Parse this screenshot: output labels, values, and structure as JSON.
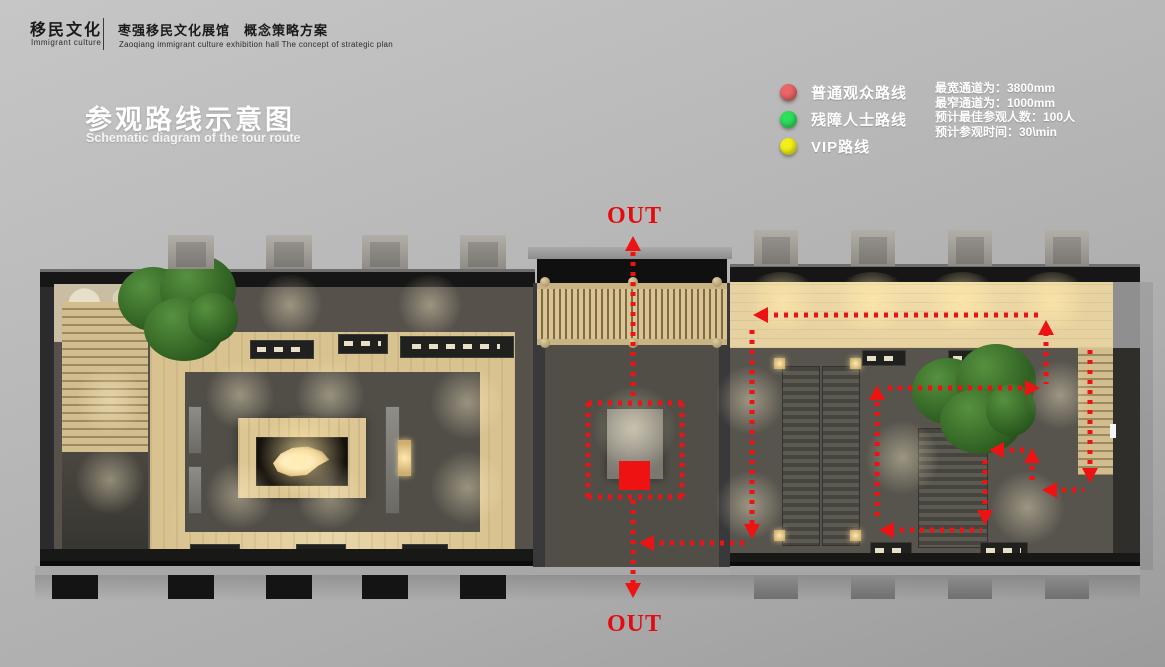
{
  "header": {
    "brand_cn": "移民文化",
    "brand_en": "Immigrant culture",
    "project_cn": "枣强移民文化展馆　概念策略方案",
    "project_en": "Zaoqiang immigrant culture exhibition hall  The concept of strategic plan"
  },
  "title": {
    "cn": "参观路线示意图",
    "en": "Schematic diagram of the tour route"
  },
  "legend": {
    "items": [
      {
        "name": "ordinary-visitor-route",
        "label": "普通观众路线",
        "color": "#e96666"
      },
      {
        "name": "disabled-visitor-route",
        "label": "残障人士路线",
        "color": "#2ce05a"
      },
      {
        "name": "vip-route",
        "label": "VIP路线",
        "color": "#f2ef18"
      }
    ]
  },
  "stats": {
    "lines": [
      "最宽通道为：3800mm",
      "最窄通道为：1000mm",
      "预计最佳参观人数：100人",
      "预计参观时间：30\\min"
    ]
  },
  "plan": {
    "exits": {
      "top": "OUT",
      "bottom": "OUT"
    },
    "route": {
      "color": "#ee1212",
      "width": 5,
      "dash": [
        4,
        6
      ],
      "segments": [
        [
          633,
          252,
          633,
          398
        ],
        [
          588,
          403,
          682,
          403
        ],
        [
          682,
          403,
          682,
          497
        ],
        [
          682,
          497,
          588,
          497
        ],
        [
          588,
          497,
          588,
          403
        ],
        [
          633,
          500,
          633,
          584
        ],
        [
          650,
          543,
          748,
          543
        ],
        [
          752,
          330,
          752,
          530
        ],
        [
          764,
          315,
          1040,
          315
        ],
        [
          1046,
          332,
          1046,
          384
        ],
        [
          888,
          388,
          1028,
          388
        ],
        [
          877,
          392,
          877,
          522
        ],
        [
          890,
          530,
          982,
          530
        ],
        [
          985,
          460,
          985,
          516
        ],
        [
          1000,
          450,
          1026,
          450
        ],
        [
          1032,
          456,
          1032,
          486
        ],
        [
          1052,
          490,
          1084,
          490
        ],
        [
          1090,
          350,
          1090,
          474
        ]
      ],
      "arrows": [
        [
          633,
          236,
          "up"
        ],
        [
          633,
          598,
          "down"
        ],
        [
          639,
          543,
          "left"
        ],
        [
          752,
          539,
          "down"
        ],
        [
          753,
          315,
          "left"
        ],
        [
          1046,
          320,
          "up"
        ],
        [
          1040,
          388,
          "right"
        ],
        [
          877,
          385,
          "up"
        ],
        [
          879,
          530,
          "left"
        ],
        [
          985,
          525,
          "down"
        ],
        [
          989,
          450,
          "left"
        ],
        [
          1032,
          448,
          "up"
        ],
        [
          1042,
          490,
          "left"
        ],
        [
          1090,
          483,
          "down"
        ]
      ],
      "highlight_square": [
        619,
        461,
        31,
        29
      ]
    }
  }
}
